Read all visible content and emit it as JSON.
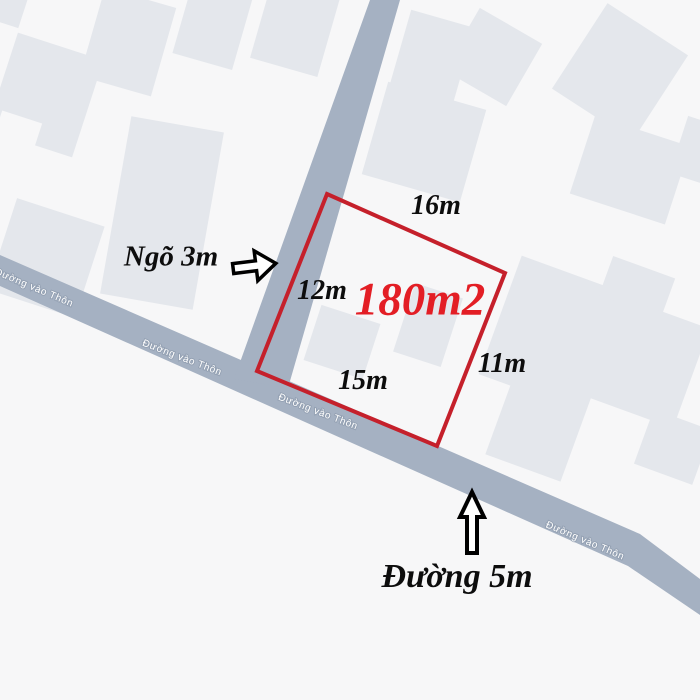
{
  "map": {
    "road_name": "Đường vào Thôn",
    "plot": {
      "area": "180m2",
      "sides": {
        "top": "16m",
        "left": "12m",
        "bottom": "15m",
        "right": "11m"
      }
    },
    "callouts": {
      "alley": "Ngõ 3m",
      "road": "Đường 5m"
    },
    "colors": {
      "background": "#f7f7f8",
      "building": "#e4e7ec",
      "road": "#a5b1c2",
      "plot_outline": "#c5202b",
      "area_text": "#e31e25"
    }
  }
}
